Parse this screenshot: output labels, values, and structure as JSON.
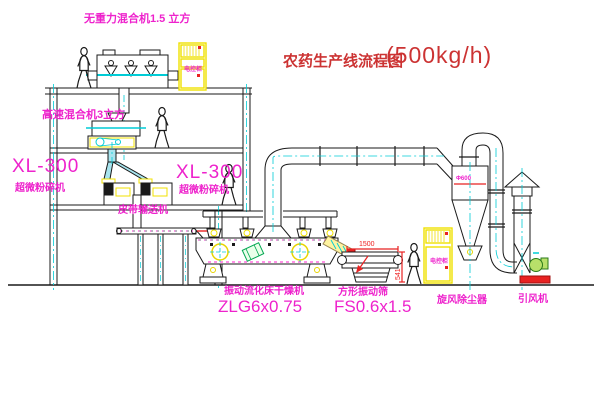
{
  "title": {
    "zh": "农药生产线流程图",
    "capacity": "(500kg/h)"
  },
  "equipment": {
    "gravity_mixer": "无重力混合机1.5 立方",
    "high_speed_mixer": "高速混合机3立方",
    "pulverizer_model": "XL-300",
    "pulverizer_name": "超微粉碎机",
    "belt_conveyor": "皮带输送机",
    "dryer_name": "振动流化床干燥机",
    "dryer_model": "ZLG6x0.75",
    "screen_name": "方形振动筛",
    "screen_model": "FS0.6x1.5",
    "cyclone": "旋风除尘器",
    "fan": "引风机",
    "control_cabinet": "电控柜",
    "cyclone_tag": "Φ600"
  },
  "dimensions": {
    "screen_length": "1500",
    "screen_height": "541"
  },
  "colors": {
    "label_magenta": "#ee22cc",
    "title_red": "#cc3333",
    "dimension_red": "#ee2222",
    "centerline_cyan": "#00ccd6",
    "cabinet_yellow": "#f0e000",
    "fan_green": "#2a7a1a",
    "base_red": "#e82222"
  }
}
